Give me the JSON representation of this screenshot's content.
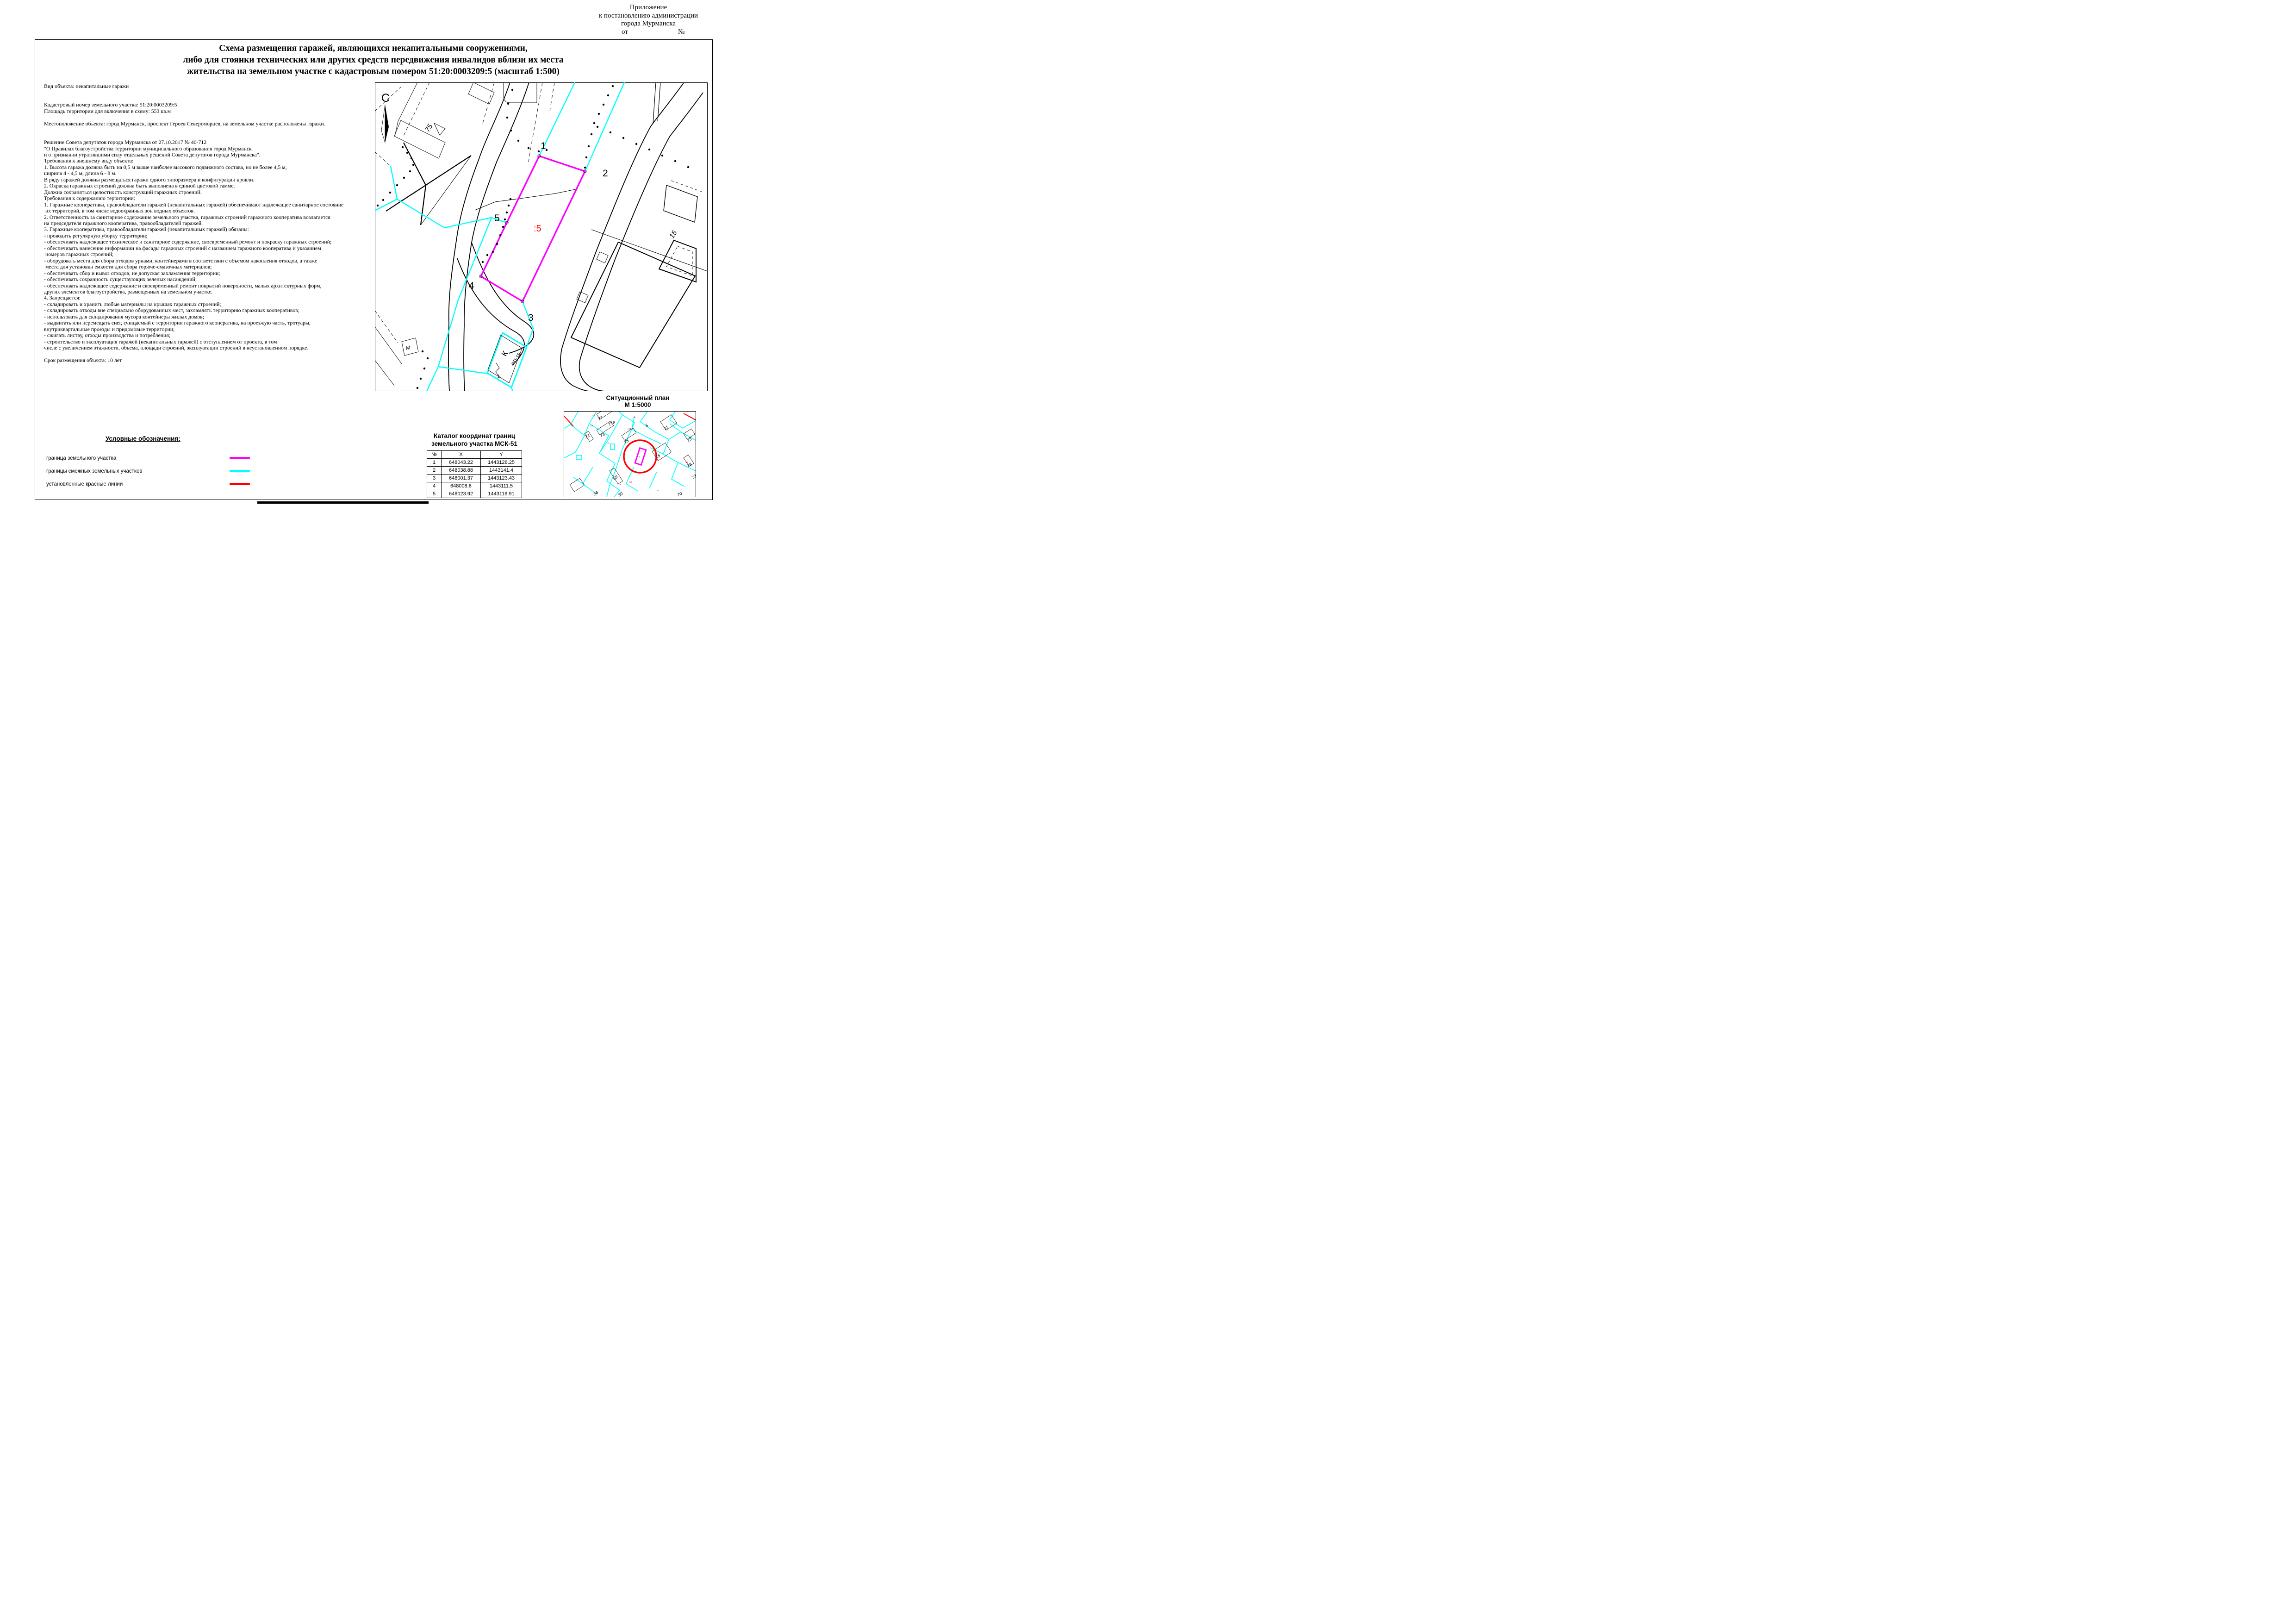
{
  "annex": {
    "line1": "Приложение",
    "line2": "к постановлению администрации",
    "line3": "города Мурманска",
    "ot": "от",
    "no": "№"
  },
  "title": {
    "line1": "Схема размещения гаражей, являющихся некапитальными сооружениями,",
    "line2": "либо для стоянки технических или других средств передвижения инвалидов вблизи их места",
    "line3": "жительства на земельном участке с кадастровым номером 51:20:0003209:5 (масштаб 1:500)"
  },
  "body_lines": [
    "Вид объекта: некапитальные гаражи",
    "",
    "",
    "Кадастровый номер земельного участка: 51:20:0003209:5",
    "Площадь территории для включения в схему: 553 кв.м",
    "",
    "Местоположение объекта: город Мурманск, проспект Героев Североморцев, на земельном участке расположены гаражи.",
    "",
    "",
    "Решение Совета депутатов города Мурманска от 27.10.2017 № 40-712",
    "\"О Правилах благоустройства территории муниципального образования город Мурманск",
    "и о признании утратившими силу отдельных решений Совета депутатов города Мурманска\".",
    "Требования к внешнему виду объекта:",
    "1. Высота гаража должна быть на 0,5 м выше наиболее высокого подвижного состава, но не более 4,5 м,",
    "ширина 4 - 4,5 м, длина 6 - 8 м.",
    "В ряду гаражей должны размещаться гаражи одного типоразмера и конфигурации кровли.",
    "2. Окраска гаражных строений должна быть выполнена в единой цветовой гамме.",
    "Должна сохраняться целостность конструкций гаражных строений.",
    "Требования к содержанию территории:",
    "1. Гаражные кооперативы, правообладатели гаражей (некапитальных гаражей) обеспечивают надлежащее санитарное состояние",
    " их территорий, в том числе водоохранных зон водных объектов.",
    "2. Ответственность за санитарное содержание земельного участка, гаражных строений гаражного кооператива возлагается",
    "на председателя гаражного кооператива, правообладателей гаражей.",
    "3. Гаражные кооперативы, правообладатели гаражей (некапитальных гаражей) обязаны:",
    "- проводить регулярную уборку территории;",
    "- обеспечивать надлежащее техническое и санитарное содержание, своевременный ремонт и покраску гаражных строений;",
    "- обеспечивать нанесение информации на фасады гаражных строений с названием гаражного кооператива и указанием",
    " номеров гаражных строений;",
    "- оборудовать места для сбора отходов урнами, контейнерами в соответствии с объемом накопления отходов, а также",
    " места для установки емкости для сбора горюче-смазочных материалов;",
    "- обеспечивать сбор и вывоз отходов, не допуская захламления территории;",
    "- обеспечивать сохранность существующих зеленых насаждений;",
    "- обеспечивать надлежащее содержание и своевременный ремонт покрытий поверхности, малых архитектурных форм,",
    "других элементов благоустройства, размещенных на земельном участке.",
    "4. Запрещается:",
    "- складировать и хранить любые материалы на крышах гаражных строений;",
    "- складировать отходы вне специально оборудованных мест, захламлять территорию гаражных кооперативов;",
    "- использовать для складирования мусора контейнеры жилых домов;",
    "- выдвигать или перемещать снег, счищаемый с территории гаражного кооператива, на проезжую часть, тротуары,",
    "внутриквартальные проезды и придомовые территории;",
    "- сжигать листву, отходы производства и потребления;",
    "- строительство и эксплуатация гаражей (некапитальных гаражей) с отступлением от проекта, в том",
    "числе с увеличением этажности, объема, площади строений, эксплуатации строений в неустановленном порядке.",
    "",
    "Срок размещения объекта: 10 лет"
  ],
  "legend": {
    "heading": "Условные обозначения:",
    "items": [
      {
        "label": "граница земельного участка",
        "color": "#FF00FF"
      },
      {
        "label": "границы смежных земельных участков",
        "color": "#00FFFF"
      },
      {
        "label": "установленные красные линии",
        "color": "#FF0000"
      }
    ]
  },
  "catalog": {
    "heading_line1": "Каталог координат границ",
    "heading_line2": "земельного участка МСК-51",
    "columns": [
      "№",
      "X",
      "Y"
    ],
    "rows": [
      [
        "1",
        "648043.22",
        "1443128.25"
      ],
      [
        "2",
        "648038.88",
        "1443141.4"
      ],
      [
        "3",
        "648001.37",
        "1443123.43"
      ],
      [
        "4",
        "648008.6",
        "1443111.5"
      ],
      [
        "5",
        "648023.92",
        "1443118.91"
      ]
    ]
  },
  "situational": {
    "heading_line1": "Ситуационный план",
    "heading_line2": "М 1:5000"
  },
  "map": {
    "north_label": "С",
    "labels": {
      "building75": "75",
      "v1": "1",
      "v2": "2",
      "v3": "3",
      "v4": "4",
      "v5": "5",
      "parcel": ":5",
      "building15": "15",
      "m_box": "М",
      "k_box": "К",
      "k_box_sub": "РП-16"
    }
  },
  "minimap_labels": {
    "buildings": [
      "77",
      "77а",
      "71",
      "73",
      "75",
      "5",
      "11",
      "13",
      "15",
      "69",
      "78",
      "72",
      "26",
      "30",
      "70"
    ],
    "parcels": [
      ":46",
      ":48",
      ":39",
      ":38",
      ":37",
      ":47",
      ":52",
      ":32",
      ":29",
      ":10",
      ":9",
      ":5"
    ]
  },
  "colors": {
    "parcel_boundary": "#FF00FF",
    "adjacent_boundaries": "#00FFFF",
    "red_lines": "#FF0000",
    "parcel_label": "#FF0000"
  }
}
